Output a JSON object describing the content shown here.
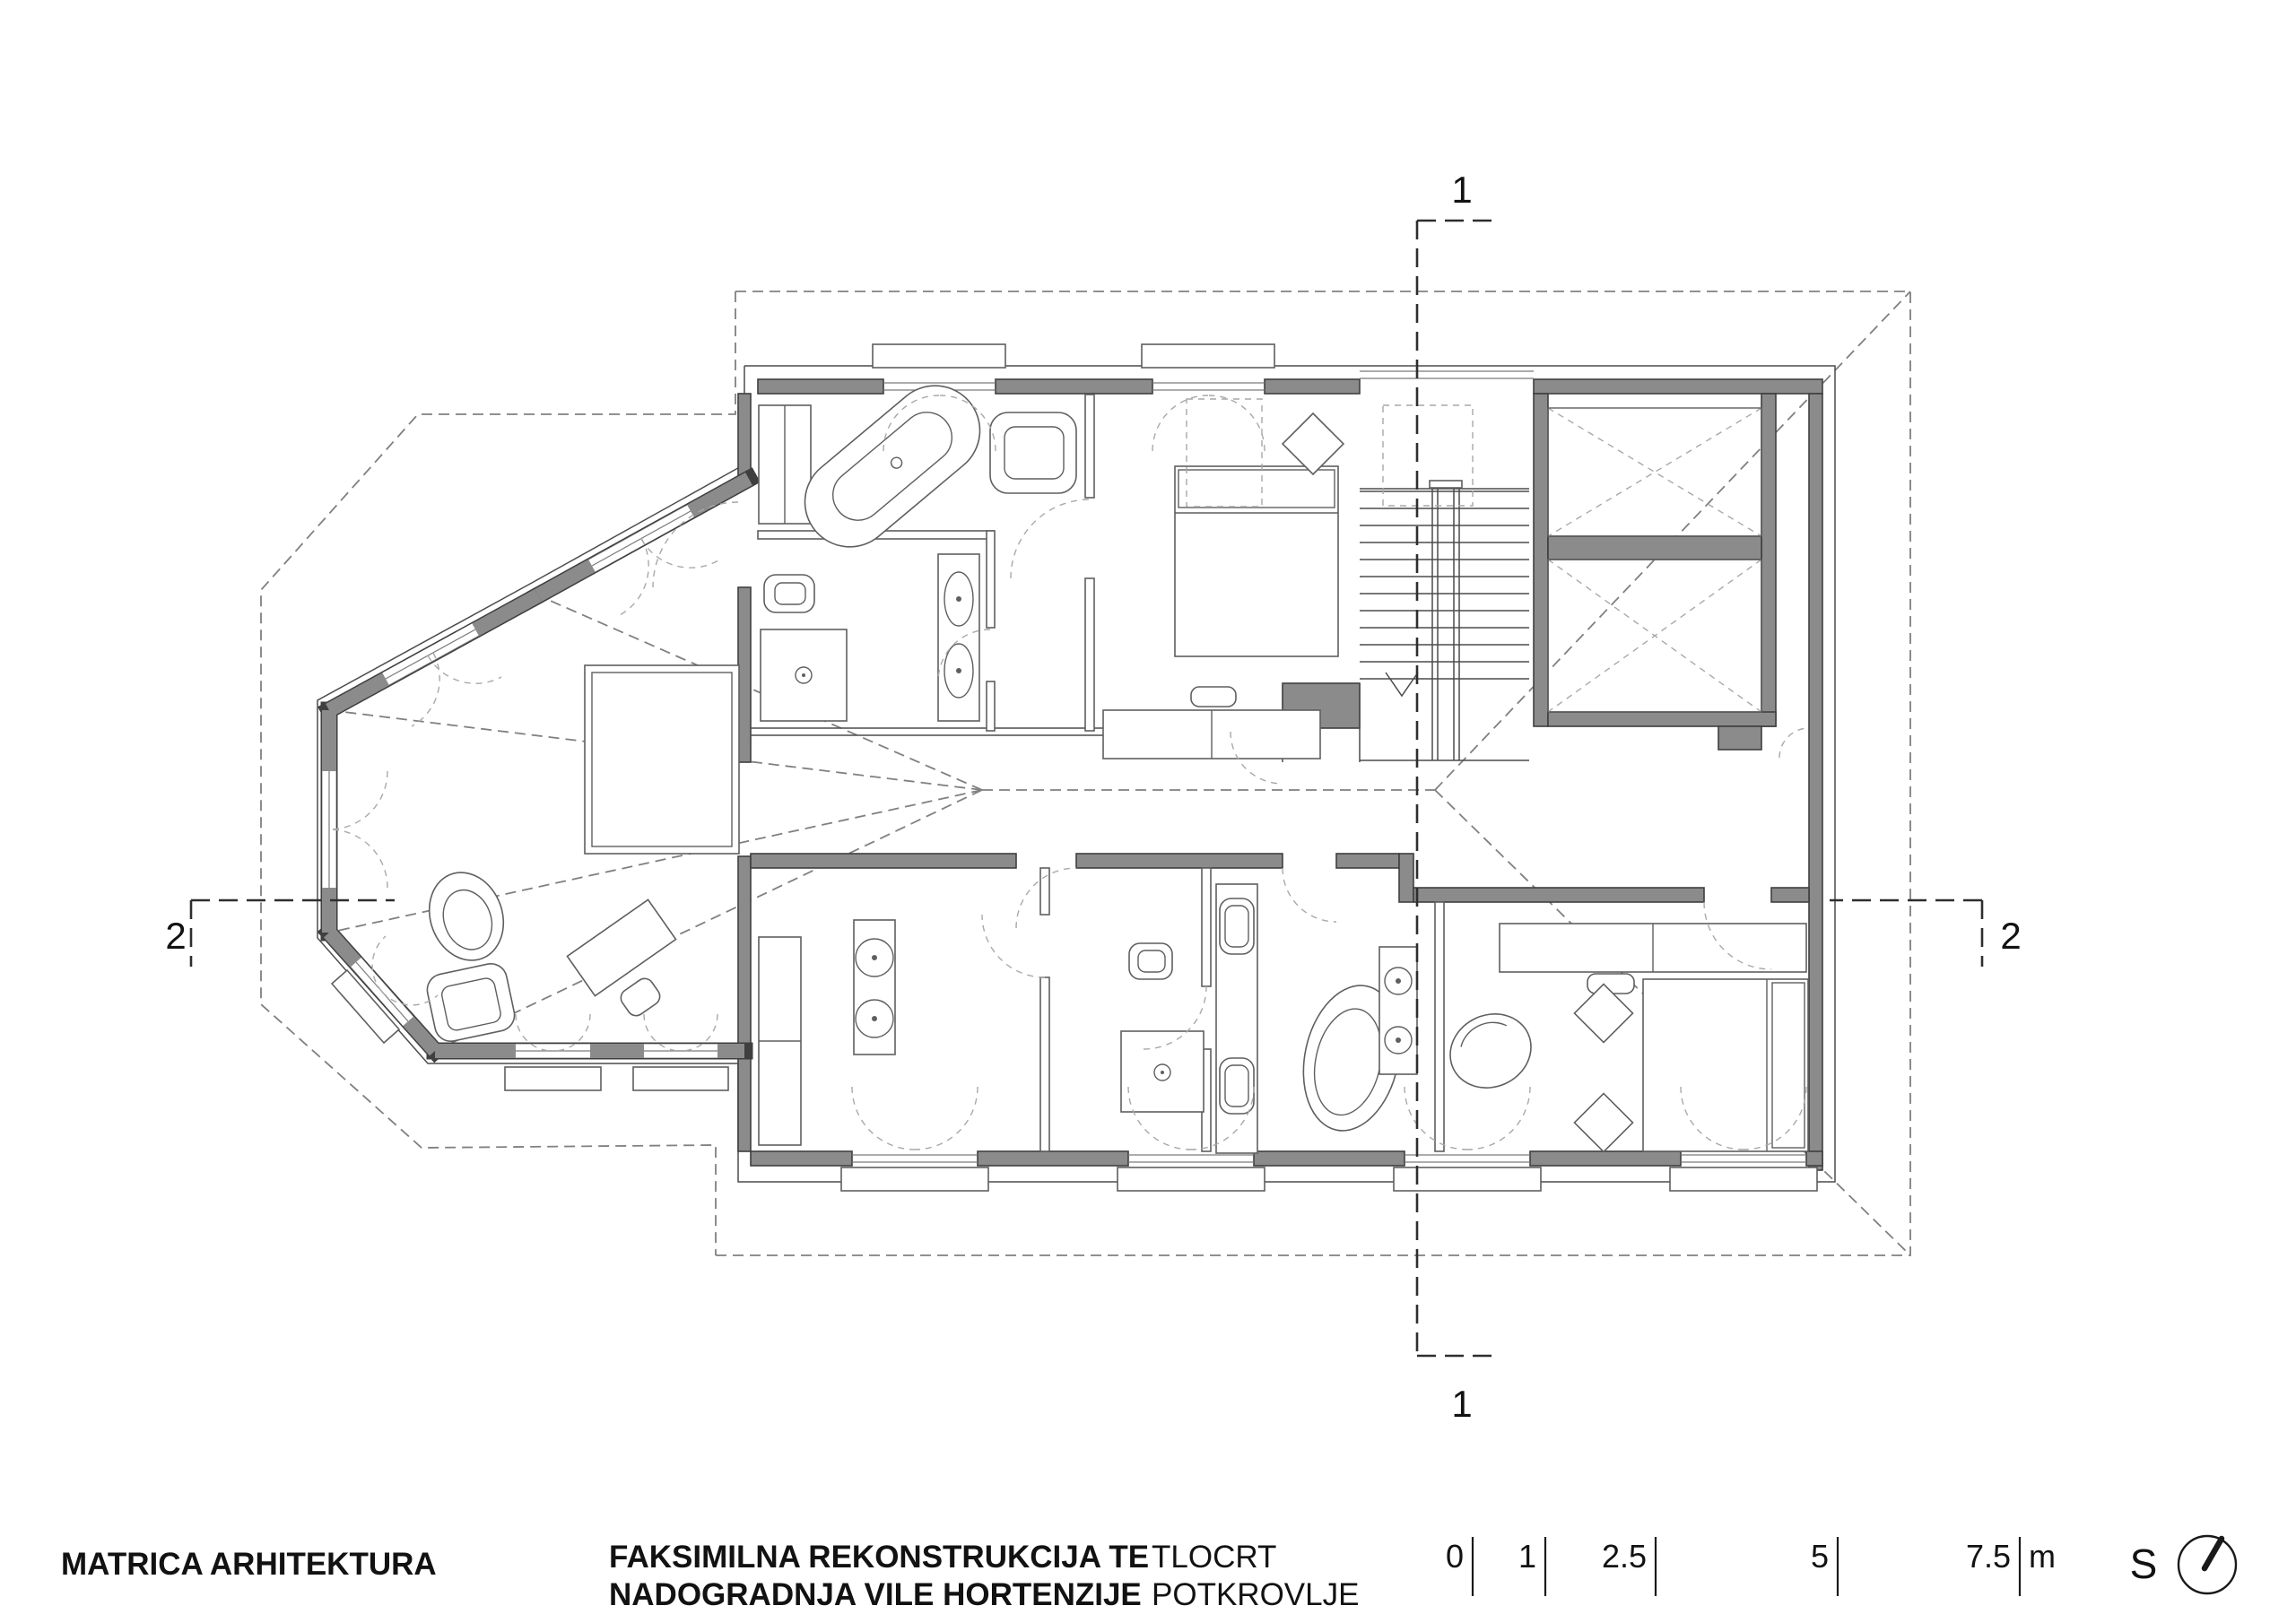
{
  "title_block": {
    "firm": "MATRICA ARHITEKTURA",
    "project_line1": "FAKSIMILNA REKONSTRUKCIJA TE",
    "project_line2": "NADOGRADNJA VILE HORTENZIJE",
    "drawing_line1": "TLOCRT",
    "drawing_line2": "POTKROVLJE"
  },
  "scale_bar": {
    "ticks": [
      {
        "label": "0"
      },
      {
        "label": "1"
      },
      {
        "label": "2.5"
      },
      {
        "label": "5"
      },
      {
        "label": "7.5"
      }
    ],
    "unit": "m"
  },
  "north": {
    "label": "S"
  },
  "section_markers": {
    "s1_top": "1",
    "s1_bottom": "1",
    "s2_left": "2",
    "s2_right": "2"
  },
  "colors": {
    "wall_fill": "#8b8b8b",
    "line": "#3f3f3f",
    "background": "#ffffff"
  }
}
